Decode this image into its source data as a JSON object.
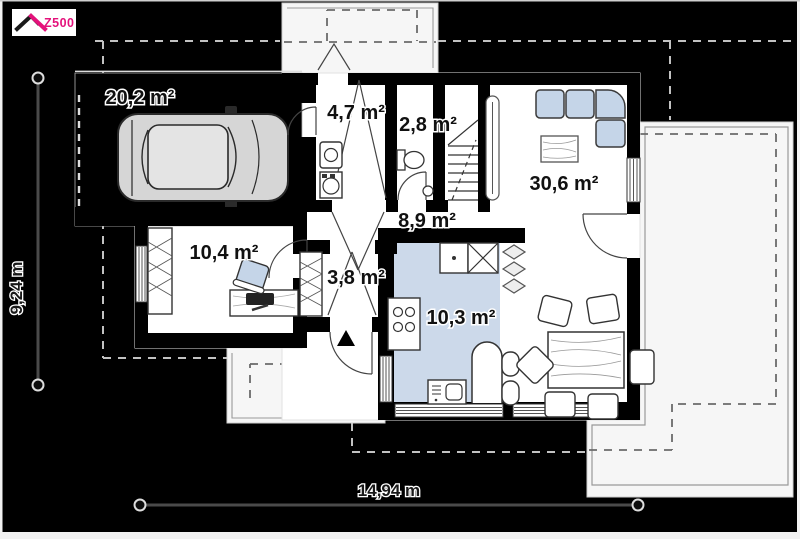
{
  "logo": {
    "text": "Z500"
  },
  "rooms": {
    "garage": {
      "label": "20,2 m²"
    },
    "vestibule": {
      "label": "4,7 m²"
    },
    "wc": {
      "label": "2,8 m²"
    },
    "living_room": {
      "label": "30,6 m²"
    },
    "hall": {
      "label": "8,9 m²"
    },
    "office": {
      "label": "10,4 m²"
    },
    "closet": {
      "label": "3,8 m²"
    },
    "kitchen": {
      "label": "10,3 m²"
    }
  },
  "dimensions": {
    "width_label": "14,94 m",
    "height_label": "9,24 m"
  },
  "colors": {
    "brand_magenta": "#e4127b",
    "furniture_blue": "#c5d5e8",
    "kitchen_floor": "#ccd9ea",
    "background": "#000000",
    "floor_white": "#ffffff",
    "terrace_white": "#f6f6f6"
  },
  "icons": {
    "car": "car-icon",
    "sofa": "corner-sofa-icon",
    "coffee_table": "coffee-table-icon",
    "dining_table": "dining-table-icon",
    "stairs": "stairs-icon",
    "toilet": "toilet-icon",
    "cooktop": "cooktop-icon",
    "sink": "sink-icon",
    "fridge": "fridge-icon",
    "desk": "desk-icon",
    "wardrobe": "wardrobe-icon",
    "radiator": "radiator-icon",
    "entrance_arrow": "entrance-arrow-icon",
    "roof": "roof-icon"
  }
}
